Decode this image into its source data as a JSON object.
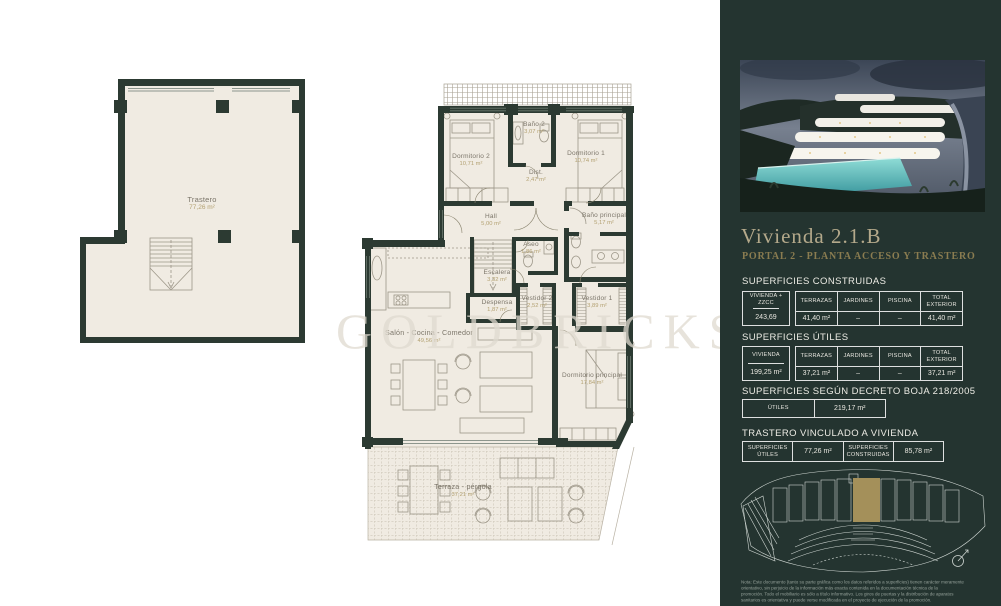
{
  "watermark": "GOLDBRICKS",
  "colors": {
    "panel_bg": "#243430",
    "paper": "#f0ebe2",
    "wall": "#2c3a32",
    "accent_gold": "#a4905a",
    "area_text": "#b3a172"
  },
  "plans": {
    "trastero": {
      "rooms": [
        {
          "name": "Trastero",
          "area": "77,26 m²"
        }
      ]
    },
    "apartment": {
      "rooms": [
        {
          "name": "Dormitorio 2",
          "area": "10,71 m²"
        },
        {
          "name": "Baño 2",
          "area": "3,07 m²"
        },
        {
          "name": "Dormitorio 1",
          "area": "10,74 m²"
        },
        {
          "name": "Dist.",
          "area": "2,47 m²"
        },
        {
          "name": "Hall",
          "area": "5,00 m²"
        },
        {
          "name": "Baño principal",
          "area": "5,17 m²"
        },
        {
          "name": "Aseo",
          "area": "1,86 m²"
        },
        {
          "name": "Escalera",
          "area": "3,32 m²"
        },
        {
          "name": "Despensa",
          "area": "1,87 m²"
        },
        {
          "name": "Vestidor 2",
          "area": "2,52 m²"
        },
        {
          "name": "Vestidor 1",
          "area": "3,89 m²"
        },
        {
          "name": "Salón - Cocina - Comedor",
          "area": "49,56 m²"
        },
        {
          "name": "Dormitorio principal",
          "area": "17,84 m²"
        },
        {
          "name": "Terraza - pérgola",
          "area": "37,21 m²"
        }
      ]
    }
  },
  "panel": {
    "title": "Vivienda 2.1.B",
    "subtitle": "PORTAL 2 - PLANTA ACCESO Y TRASTERO",
    "sections": {
      "construidas": {
        "heading": "SUPERFICIES CONSTRUIDAS",
        "first_header": "VIVIENDA + ZZCC",
        "first_value": "243,69",
        "headers": [
          "TERRAZAS",
          "JARDINES",
          "PISCINA",
          "TOTAL EXTERIOR"
        ],
        "values": [
          "41,40 m²",
          "–",
          "–",
          "41,40 m²"
        ]
      },
      "utiles": {
        "heading": "SUPERFICIES ÚTILES",
        "first_header": "VIVIENDA",
        "first_value": "199,25 m²",
        "headers": [
          "TERRAZAS",
          "JARDINES",
          "PISCINA",
          "TOTAL EXTERIOR"
        ],
        "values": [
          "37,21 m²",
          "–",
          "–",
          "37,21 m²"
        ]
      },
      "boja": {
        "heading": "SUPERFICIES SEGÚN DECRETO BOJA 218/2005",
        "cells": [
          "ÚTILES",
          "219,17 m²"
        ]
      },
      "trastero": {
        "heading": "TRASTERO VINCULADO A VIVIENDA",
        "cells": [
          "SUPERFICIES ÚTILES",
          "77,26 m²",
          "SUPERFICIES CONSTRUIDAS",
          "85,78 m²"
        ]
      }
    },
    "note_lines": [
      "Nota: Este documento (tanto su parte gráfica como los datos referidos a superficies) tienen carácter meramente",
      "orientativo, sin perjuicio de la información más exacta contenida en la documentación técnica de la",
      "promoción. Todo el mobiliario es sólo a título informativo. Los giros de puertas y la distribución de aparatos",
      "sanitarios es orientativa y puede verse modificada en el proyecto de ejecución de la promoción."
    ]
  }
}
